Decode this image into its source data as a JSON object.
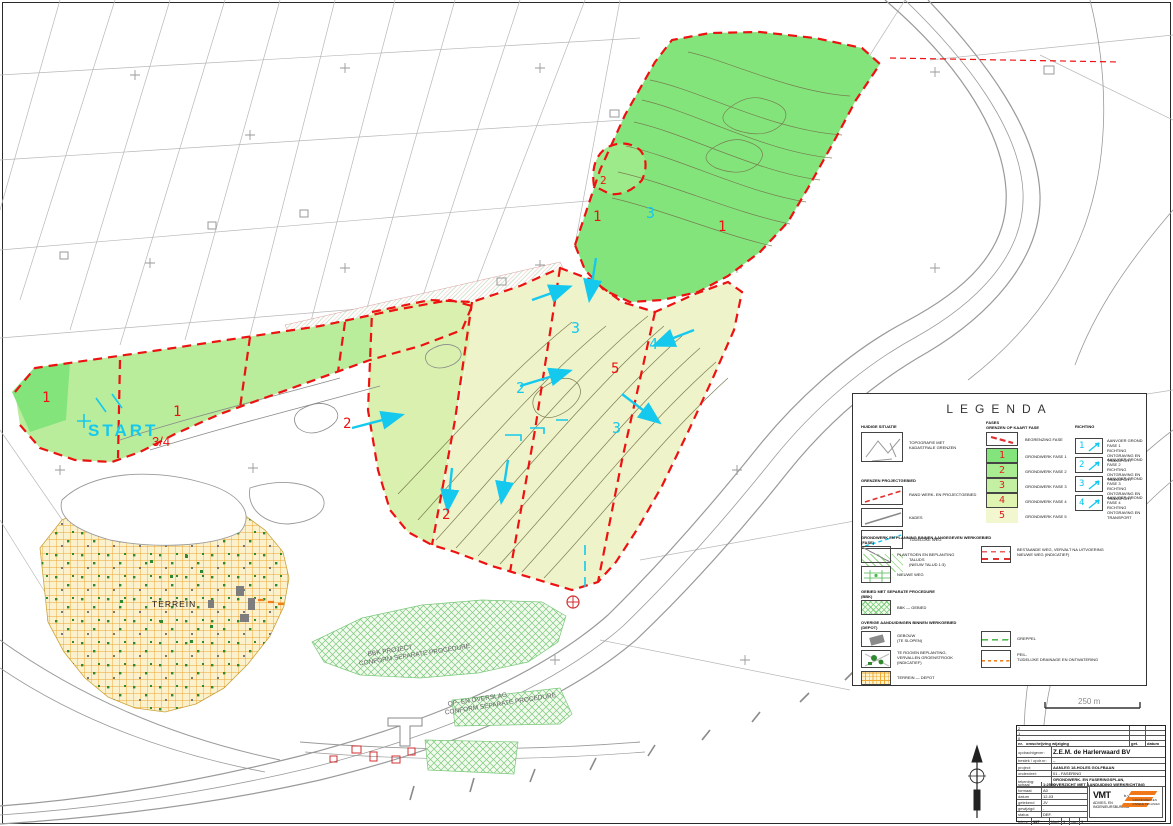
{
  "map": {
    "start": "START",
    "start_phase": "3/4",
    "terrein": "TERREIN",
    "bbk1": "BBK PROJECT",
    "bbk2": "CONFORM SEPARATE PROCEDURE",
    "overslag1": "OP- EN OVERSLAG",
    "overslag2": "CONFORM SEPARATE PROCEDURE",
    "red_numbers": [
      "1",
      "1",
      "2",
      "2",
      "1",
      "1",
      "5",
      "2"
    ],
    "cyan_numbers": [
      "3",
      "3",
      "2",
      "4",
      "3"
    ],
    "scalebar_label": "250 m"
  },
  "legend": {
    "title": "LEGENDA",
    "left": {
      "header1": "HUIDIGE SITUATIE",
      "row1": "TOPOGRAFIE MET\nKADASTRALE GRENZEN",
      "header2": "GRENZEN PROJECTGEBIED",
      "row2": "RAND WERK- EN PROJECTGEBIED",
      "row3": "KADES",
      "row4": "TIJDELIJKE WEG",
      "row5": "TALUDS\n(NIEUW TALUD 1:3)"
    },
    "mid": {
      "header": "FASES\nGRENZEN OP KAART FASE",
      "boundary": "BEGRENZING FASE",
      "phases": [
        {
          "num": "1",
          "label": "GRONDWERK FASE 1"
        },
        {
          "num": "2",
          "label": "GRONDWERK FASE 2"
        },
        {
          "num": "3",
          "label": "GRONDWERK FASE 3"
        },
        {
          "num": "4",
          "label": "GRONDWERK FASE 4"
        },
        {
          "num": "5",
          "label": "GRONDWERK FASE 5"
        }
      ]
    },
    "right": {
      "header": "RICHTING",
      "items": [
        {
          "num": "1",
          "label": "AANVOER GROND FASE 1\nRICHTING ONTGRAVING EN\nTRANSPORT"
        },
        {
          "num": "2",
          "label": "AANVOER GROND FASE 2\nRICHTING ONTGRAVING EN\nTRANSPORT"
        },
        {
          "num": "3",
          "label": "AANVOER GROND FASE 3\nRICHTING ONTGRAVING EN\nTRANSPORT"
        },
        {
          "num": "4",
          "label": "AANVOER GROND FASE 4\nRICHTING ONTGRAVING EN\nTRANSPORT"
        }
      ]
    },
    "bottom": {
      "header1": "GRONDWERK EN PLANNING BINNEN AANGEGEVEN WERKGEBIED\n(FASE)",
      "row_road1": "PLANTSOEN EN BEPLANTING",
      "row_road2": "NIEUWE WEG",
      "row_redroad": "BESTAANDE WEG, VERVALT NA UITVOERING\nNIEUWE WEG (INDICATIEF)",
      "header2": "GEBIED MET SEPARATE PROCEDURE\n(BBK)",
      "row_bbk": "BBK — GEBIED",
      "header3": "OVERIGE AANDUIDINGEN BINNEN WERKGEBIED\n(DEPOT)",
      "row_building": "GEBOUW\n(TE SLOPEN)",
      "row_green": "TE ROOIEN BEPLANTING,\nVERVALLEN GROENSTROOK\n(INDICATIEF)",
      "row_depot": "TERREIN — DEPOT",
      "row_ditch": "GREPPEL",
      "row_drain": "PEIL-\nTIJDELIJKE DRAINAGE EN ONTWATERING"
    }
  },
  "titleblock": {
    "rev": [
      {
        "nr": "2",
        "get": "",
        "datum": ""
      },
      {
        "nr": "1",
        "get": "",
        "datum": ""
      },
      {
        "nr": "0",
        "get": "",
        "datum": ""
      }
    ],
    "rev_header": {
      "nr": "nr.",
      "descr": "omschrijving wijziging",
      "get": "get.",
      "datum": "datum"
    },
    "fields": [
      {
        "label": "opdrachtgever:",
        "value": "Z.E.M. de Harlerwaard BV"
      },
      {
        "label": "bestek / opdr.nr:",
        "value": "–"
      },
      {
        "label": "project:",
        "value": "AANLEG 18-HOLES GOLFBAAN"
      },
      {
        "label": "onderdeel:",
        "value": "01 - FASERING"
      },
      {
        "label": "tekening:",
        "value": "GRONDWERK- EN FASERINGSPLAN,",
        "value2": "OVERZICHT MET AANDUIDING WERKRICHTING"
      }
    ],
    "meta": [
      {
        "label": "schaal",
        "value": "1:2500"
      },
      {
        "label": "formaat",
        "value": "A0"
      },
      {
        "label": "datum",
        "value": "12-03"
      },
      {
        "label": "getekend",
        "value": "JV"
      },
      {
        "label": "gewijzigd",
        "value": "-"
      },
      {
        "label": "status",
        "value": "DEF."
      }
    ],
    "bottomrow": {
      "teknr_label": "tek.nr",
      "teknr": "117",
      "blad_label": "blad",
      "blad": "1",
      "van_label": "van",
      "van": "1"
    },
    "logo": {
      "word": "VMT",
      "bv": "b.v.",
      "sub": "ADVIES- EN\nINGENIEURSBUREAU",
      "rsub": "GRONDWERKEN\nCIVIELE TECHNIEK"
    }
  }
}
